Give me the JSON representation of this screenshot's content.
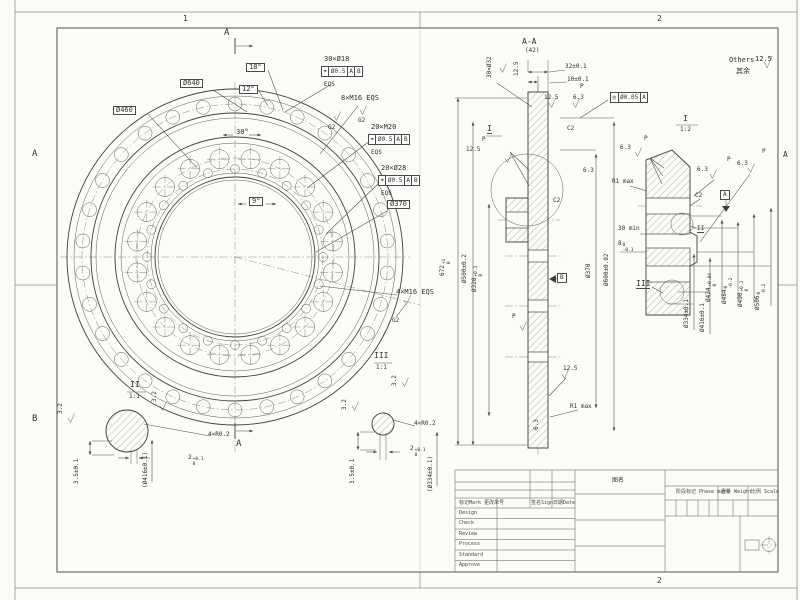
{
  "sheet": {
    "zones": {
      "left_a": "A",
      "left_b": "B",
      "right_a": "A",
      "top_1": "1",
      "top_2": "2",
      "bottom_2": "2"
    },
    "others": {
      "label": "Others",
      "value": "12.5",
      "cn": "其余"
    }
  },
  "common": {
    "p": "P",
    "eqs": "EQS",
    "g2": "G2",
    "c2": "C2",
    "f125": "12.5",
    "f63": "6.3",
    "f32": "3.2",
    "r1max": "R1 max",
    "sec": "A"
  },
  "front": {
    "d640": "Ø640",
    "d460": "Ø460",
    "d370": "Ø370",
    "a18": "18°",
    "a12": "12°",
    "a30": "30°",
    "a9": "9°",
    "holes30": {
      "qty": "30×Ø18",
      "sym": "⌖",
      "tol": "Ø0.5",
      "da": "A",
      "db": "B"
    },
    "tap8": "8×M16 EQS",
    "tap20": {
      "qty": "20×M20",
      "sym": "⌖",
      "tol": "Ø0.5",
      "da": "A",
      "db": "B"
    },
    "holes20": {
      "qty": "20×Ø28",
      "sym": "⌖",
      "tol": "Ø0.5",
      "da": "A",
      "db": "B"
    },
    "tap4": "4×M16 EQS"
  },
  "section": {
    "title": "A-A",
    "scale": "(42)",
    "d30x32": "30×Ø32",
    "w32": "32±0.1",
    "w10": "10±0.1",
    "len672": {
      "v": "672",
      "u": "+1",
      "d": "0"
    },
    "d500": "Ø500±0.2",
    "d320": {
      "v": "Ø320",
      "u": "+0.1",
      "d": "0"
    },
    "d370": "Ø370",
    "d600": "Ø600±0.02",
    "datum_b": "B",
    "det": "I"
  },
  "detail1": {
    "label": "I",
    "scale": "1:2",
    "min30": "30 min",
    "h8": {
      "v": "8",
      "u": "0",
      "d": "-0.1"
    },
    "ref2": "II",
    "ref3": "III",
    "d334": "Ø334±0.1",
    "d416": "Ø416±0.1",
    "d424": {
      "v": "Ø424",
      "u": "+0.04",
      "d": "0"
    },
    "d484": {
      "v": "Ø484",
      "u": "0",
      "d": "-0.2"
    },
    "d490": {
      "v": "Ø490",
      "u": "+0.2",
      "d": "0"
    },
    "d506": {
      "v": "Ø506",
      "u": "0",
      "d": "-0.2"
    },
    "datum_a": "A"
  },
  "detail2": {
    "label": "II",
    "scale": "1:1",
    "r": "4×R0.2",
    "t2": {
      "v": "2",
      "u": "+0.1",
      "d": "0"
    },
    "t35": "3.5±0.1",
    "dia": "(Ø416±0.1)"
  },
  "detail3": {
    "label": "III",
    "scale": "1:1",
    "r": "4×R0.2",
    "t2": {
      "v": "2",
      "u": "+0.1",
      "d": "0"
    },
    "t35": "3.5±0.1",
    "dia": "(Ø334±0.1)"
  },
  "conc": {
    "sym": "◎",
    "tol": "Ø0.05",
    "datum": "A"
  },
  "titleblock": {
    "header_mark": "标记Mark 更改单号",
    "header_sign": "签名Sign",
    "header_date": "日期Date",
    "rows": [
      "Design",
      "Check",
      "Review",
      "Process",
      "Standard",
      "Approve"
    ],
    "phase": "阶段标记 Phase mark",
    "weight": "重量 Weight",
    "scale_lbl": "比例 Scale",
    "title_cn": "图名"
  }
}
